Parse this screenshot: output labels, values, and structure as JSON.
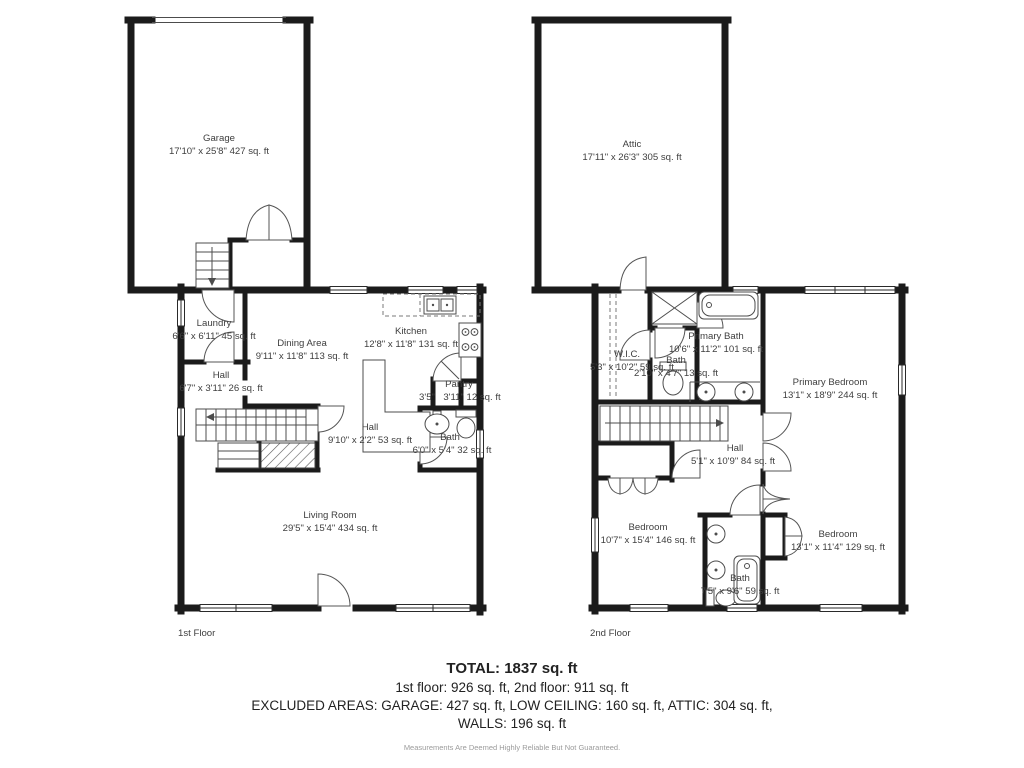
{
  "colors": {
    "wall": "#1b1b1b",
    "text": "#3e3e3e",
    "accent": "#ffffff"
  },
  "floor1": {
    "label": "1st Floor",
    "rooms": {
      "garage": {
        "name": "Garage",
        "dims": "17'10\" x 25'8\" 427 sq. ft"
      },
      "laundry": {
        "name": "Laundry",
        "dims": "6'6\" x 6'11\" 45 sq. ft"
      },
      "hall_small": {
        "name": "Hall",
        "dims": "6'7\" x 3'11\" 26 sq. ft"
      },
      "dining": {
        "name": "Dining Area",
        "dims": "9'11\" x 11'8\" 113 sq. ft"
      },
      "kitchen": {
        "name": "Kitchen",
        "dims": "12'8\" x 11'8\" 131 sq. ft"
      },
      "pantry": {
        "name": "Pantry",
        "dims_left": "3'5\"",
        "dims_right": "3'11\" 12 sq. ft"
      },
      "hall": {
        "name": "Hall",
        "dims": "9'10\" x 2'2\" 53 sq. ft"
      },
      "bath": {
        "name": "Bath",
        "dims": "6'0\" x 5'4\" 32 sq. ft"
      },
      "living": {
        "name": "Living Room",
        "dims": "29'5\" x 15'4\" 434 sq. ft"
      }
    }
  },
  "floor2": {
    "label": "2nd Floor",
    "rooms": {
      "attic": {
        "name": "Attic",
        "dims": "17'11\" x 26'3\" 305 sq. ft"
      },
      "wic": {
        "name": "W.I.C.",
        "dims": "5'3\" x 10'2\" 59 sq. ft"
      },
      "bath_small": {
        "name": "Bath",
        "dims": "2'10\" x 4'7\" 13 sq. ft"
      },
      "primary_bath": {
        "name": "Primary Bath",
        "dims": "10'6\" x 11'2\" 101 sq. ft"
      },
      "primary_bedroom": {
        "name": "Primary Bedroom",
        "dims": "13'1\" x 18'9\" 244 sq. ft"
      },
      "hall": {
        "name": "Hall",
        "dims": "5'1\" x 10'9\" 84 sq. ft"
      },
      "bedroom_left": {
        "name": "Bedroom",
        "dims": "10'7\" x 15'4\" 146 sq. ft"
      },
      "bath_bottom": {
        "name": "Bath",
        "dims": "7'5\" x 9'6\" 59 sq. ft"
      },
      "bedroom_right": {
        "name": "Bedroom",
        "dims": "13'1\" x 11'4\" 129 sq. ft"
      }
    }
  },
  "summary": {
    "total": "TOTAL: 1837 sq. ft",
    "floors_line": "1st floor: 926 sq. ft, 2nd floor: 911 sq. ft",
    "excluded_line1": "EXCLUDED AREAS: GARAGE: 427 sq. ft, LOW CEILING: 160 sq. ft, ATTIC: 304 sq. ft,",
    "excluded_line2": "WALLS: 196 sq. ft",
    "disclaimer": "Measurements Are Deemed Highly Reliable But Not Guaranteed."
  }
}
